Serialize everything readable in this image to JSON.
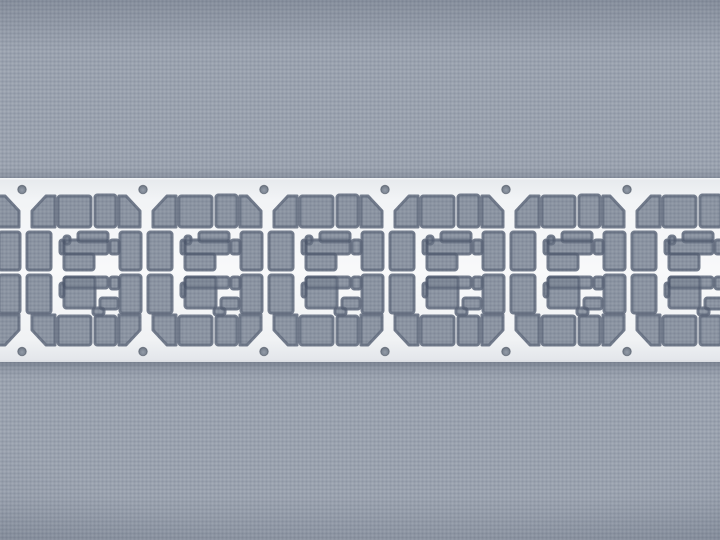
{
  "scene": {
    "description": "Macro photograph of a shiny white stamped-metal lead frame strip (repeating SIM-card style etched units with sprocket holes) lying horizontally across a gray-blue woven fabric background",
    "palette": {
      "fabric_base": "#9aa2af",
      "fabric_in_hole_tint": "rgba(50,62,88,0.14)",
      "slot_edge_line": "rgba(72,82,102,0.48)",
      "metal_top_edge": "#e6e9ed",
      "metal_upper": "#f2f4f6",
      "metal_center": "#f8f9fa",
      "metal_lower": "#f0f2f4",
      "metal_bottom_edge": "#e2e5ea",
      "edge_highlight": "#ffffff",
      "edge_dark_line": "#d8dce1",
      "hole_center": "#949ca9",
      "hole_mid": "#7e8794",
      "hole_rim": "#626a77",
      "hole_stroke": "rgba(70,78,92,0.55)"
    },
    "strip": {
      "top": 178,
      "height": 184,
      "left": -5,
      "width": 730
    },
    "units": {
      "pitch": 121,
      "first_origin_x": -99,
      "count": 7
    },
    "holes": {
      "radius": 4.3,
      "top_cy": 189.5,
      "bottom_cy": 351.5,
      "xs": [
        22,
        143,
        264,
        385,
        506,
        627
      ]
    },
    "unit": {
      "width": 121,
      "corner_paths": [
        "M10 33 L24 18 L33 18 L33 49 L10 49 Z",
        "M97 18 L104 18 L118 33 L118 49 L97 49 Z",
        "M10 137 L33 137 L33 167 L24 167 L10 152 Z",
        "M97 137 L118 137 L118 152 L104 167 L97 167 Z"
      ],
      "slot_rects": [
        [
          36,
          18,
          33,
          31
        ],
        [
          73,
          17,
          21,
          32
        ],
        [
          5,
          54,
          24,
          38
        ],
        [
          5,
          97,
          24,
          38
        ],
        [
          98,
          54,
          21,
          38
        ],
        [
          98,
          97,
          21,
          38
        ],
        [
          36,
          138,
          33,
          29
        ],
        [
          73,
          138,
          21,
          29
        ],
        [
          42,
          58,
          6,
          8
        ],
        [
          56,
          54,
          30,
          10
        ],
        [
          42,
          62,
          44,
          14
        ],
        [
          42,
          76,
          30,
          16
        ],
        [
          88,
          62,
          9,
          14
        ],
        [
          38,
          62,
          4,
          14
        ],
        [
          42,
          99,
          44,
          11
        ],
        [
          42,
          99,
          31,
          31
        ],
        [
          88,
          99,
          9,
          12
        ],
        [
          78,
          120,
          18,
          11
        ],
        [
          71,
          130,
          11,
          7
        ],
        [
          38,
          105,
          4,
          14
        ]
      ],
      "etch_expand_stroke": 3
    }
  }
}
